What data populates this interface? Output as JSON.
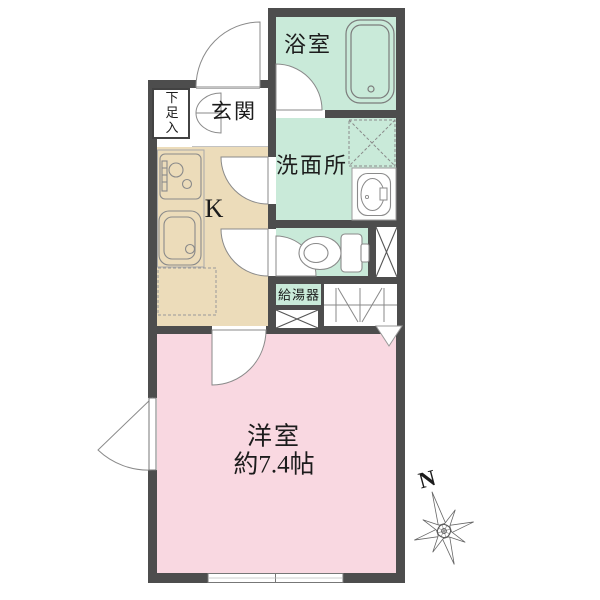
{
  "plan": {
    "type": "apartment-floor-plan",
    "rooms": {
      "bath": {
        "label": "浴室"
      },
      "entrance": {
        "label": "玄関"
      },
      "shoe_storage": {
        "label": "下足入"
      },
      "kitchen": {
        "label": "K"
      },
      "washroom": {
        "label": "洗面所"
      },
      "water_heater": {
        "label": "給湯器"
      },
      "western_room": {
        "label": "洋室",
        "area": "約7.4帖"
      }
    },
    "compass": {
      "label": "N"
    },
    "icons": [
      "bathtub-icon",
      "bath-door-swing-icon",
      "entry-door-swing-icon",
      "shoe-cabinet-doors-icon",
      "stove-icon",
      "kitchen-sink-icon",
      "refrigerator-space-icon",
      "washing-machine-space-icon",
      "wash-basin-icon",
      "toilet-icon",
      "pipe-space-icon",
      "folding-door-closet-icon",
      "casement-window-icon",
      "sliding-window-icon",
      "compass-rose-icon"
    ],
    "colors": {
      "wall": "#4d4d4d",
      "mint": "#c9ead9",
      "beige": "#ecdcba",
      "pink": "#f9d8e1",
      "line": "#8a8a8a"
    }
  }
}
